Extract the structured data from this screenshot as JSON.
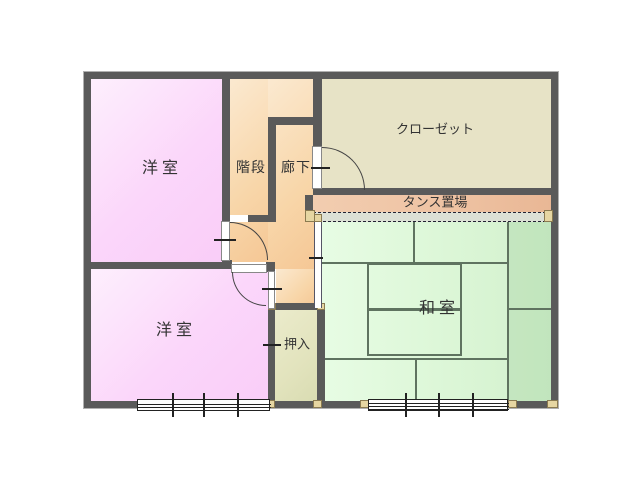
{
  "rooms": {
    "yoshitsu_upper": "洋室",
    "kaidan": "階段",
    "rouka": "廊下",
    "closet": "クローゼット",
    "tansu_okiba": "タンス置場",
    "washitsu": "和室",
    "yoshitsu_lower": "洋室",
    "oshiire": "押入"
  },
  "colors": {
    "wall": "#5a5a5a",
    "room_pink": "#fbd6fa",
    "room_stairs_corridor": "#f8d6a9",
    "room_closet": "#e7e3c6",
    "room_tansu": "#eec2a2",
    "room_tatami": "#ddf7d8",
    "room_oshiire": "#e2e3bd",
    "post": "#e6d6a2",
    "tatami_line": "#5f7360"
  }
}
